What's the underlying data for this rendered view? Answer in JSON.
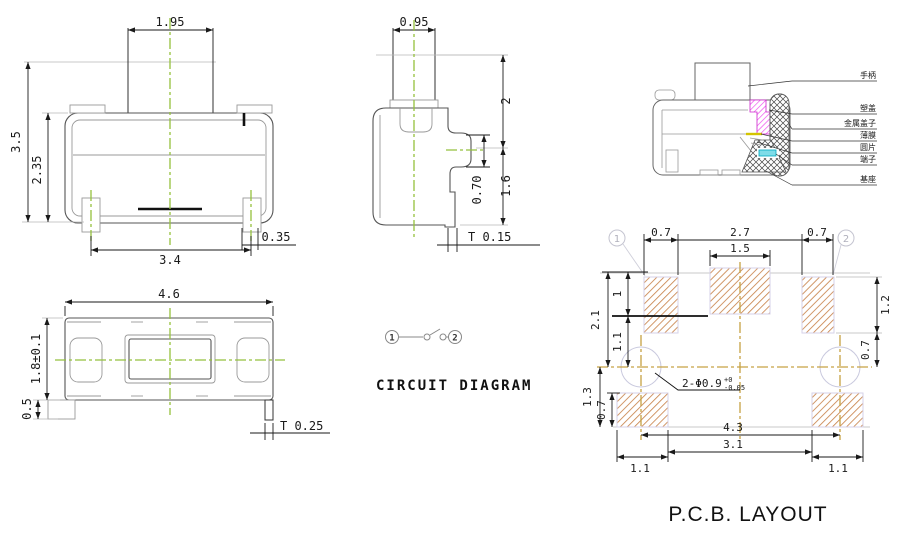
{
  "colors": {
    "centerline_green": "#94c13d",
    "centerline_khaki": "#c6a243",
    "pad_hatch_tan": "#c9854e",
    "section_magenta": "#ee44ee",
    "section_cyan": "#7fdce8",
    "membrane_yellow": "#d4c400"
  },
  "front_view": {
    "dim_stem_width": "1.95",
    "dim_total_height": "3.5",
    "dim_body_height": "2.35",
    "dim_lead_span": "3.4",
    "dim_lead_width": "0.35"
  },
  "side_view": {
    "dim_stem_width": "0.95",
    "dim_upper_height": "2",
    "dim_step_height": "0.70",
    "dim_lower_height": "1.6",
    "dim_plate_thickness": "T 0.15"
  },
  "top_view": {
    "dim_length": "4.6",
    "dim_width": "1.8±0.1",
    "dim_lead_length": "0.5",
    "dim_plate_thickness": "T 0.25"
  },
  "section_view": {
    "labels": [
      "手柄",
      "塑盖",
      "金属盖子",
      "薄膜",
      "圆片",
      "端子",
      "基座"
    ]
  },
  "circuit_diagram": {
    "title": "CIRCUIT DIAGRAM",
    "pin_left": "1",
    "pin_right": "2"
  },
  "pcb_layout": {
    "title": "P.C.B. LAYOUT",
    "marker_left": "1",
    "marker_right": "2",
    "hole_note": "2-Φ0.9",
    "hole_tol_upper": "+0",
    "hole_tol_lower": "-0.05",
    "dim_pad_left_width": "0.7",
    "dim_pads_inner_span": "2.7",
    "dim_pad_right_width": "0.7",
    "dim_center_pad_width": "1.5",
    "dim_left_total": "2.1",
    "dim_left_upper": "1",
    "dim_left_lower": "1.1",
    "dim_right_pad_height": "1.2",
    "dim_right_pad_offset": "0.7",
    "dim_lower_left_height": "1.3",
    "dim_lower_pad_height": "0.7",
    "dim_hole_span": "4.3",
    "dim_lower_inner_span": "3.1",
    "dim_lower_pad_left_width": "1.1",
    "dim_lower_pad_right_width": "1.1"
  }
}
